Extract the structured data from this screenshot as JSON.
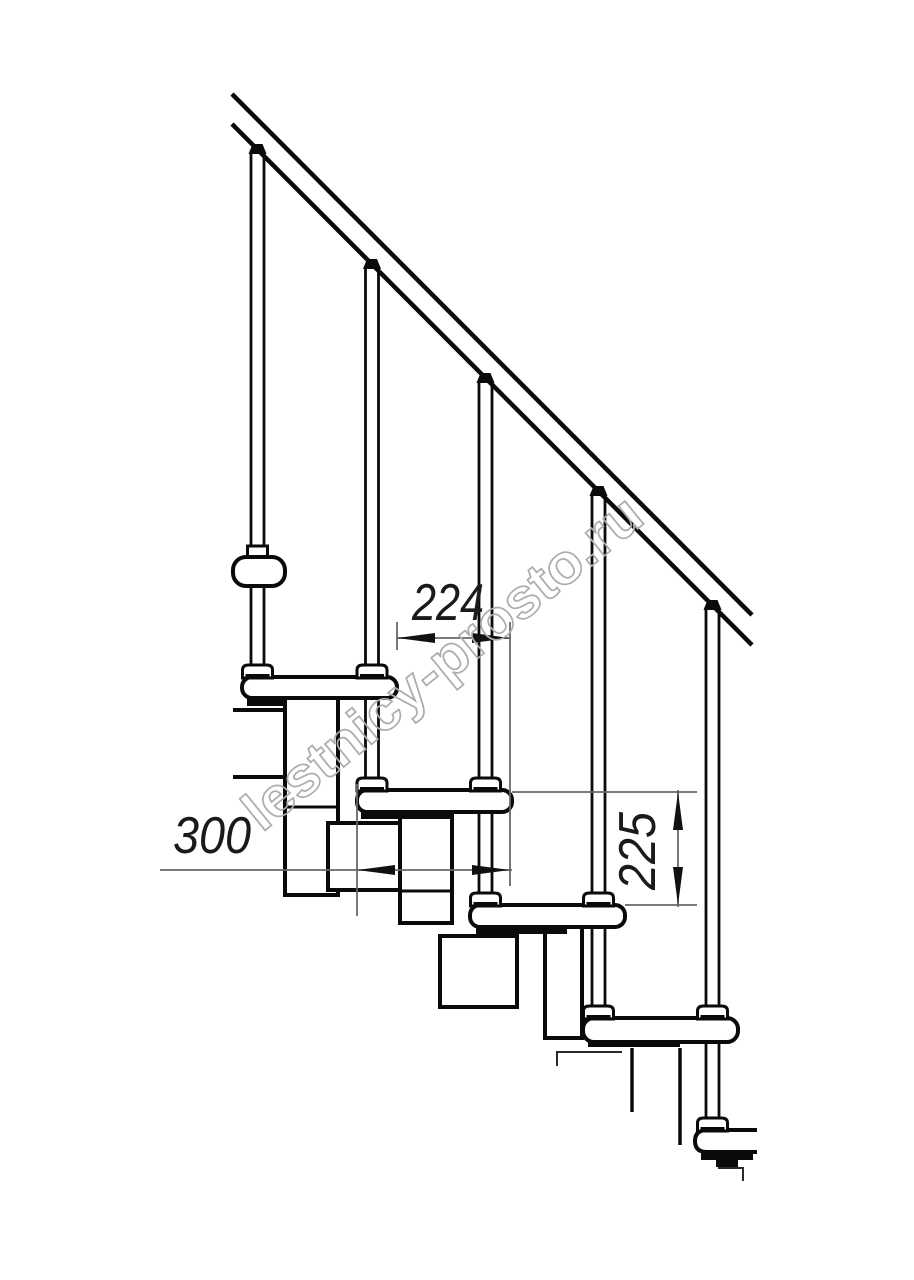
{
  "watermark": {
    "text": "lestnicy-prosto.ru",
    "color": "#adadad"
  },
  "dimensions": {
    "run": {
      "label": "224",
      "orientation": "horizontal"
    },
    "depth": {
      "label": "300",
      "orientation": "horizontal"
    },
    "riser": {
      "label": "225",
      "orientation": "vertical"
    }
  },
  "structure": {
    "balusters": 5,
    "treads": 5,
    "handrail": true
  },
  "colors": {
    "line": "#0a0a0a",
    "dimension": "#686868",
    "label": "#1a1a1a",
    "watermark": "#adadad",
    "background": "#ffffff"
  }
}
